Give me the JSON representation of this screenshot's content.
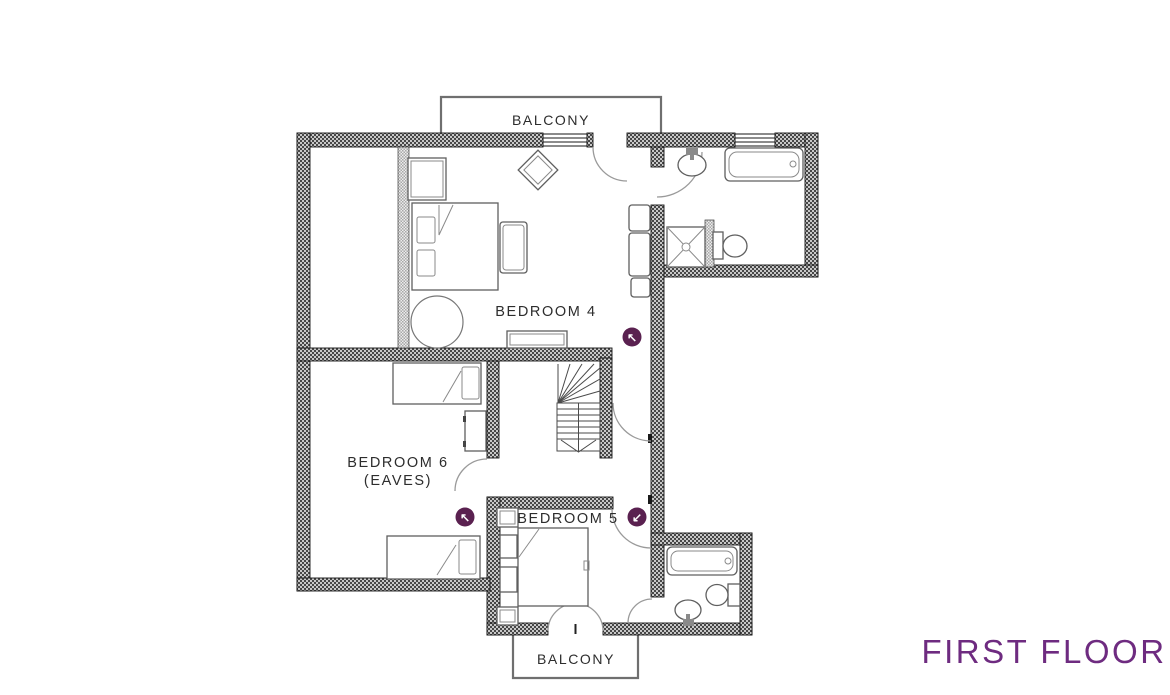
{
  "title": "FIRST FLOOR",
  "colors": {
    "title_purple": "#6e2b80",
    "marker_plum": "#5a2150",
    "wall_dark": "#474747",
    "wall_light": "#c8c8c8"
  },
  "labels": {
    "balcony_top": "BALCONY",
    "bedroom4": "BEDROOM 4",
    "bedroom6_line1": "BEDROOM 6",
    "bedroom6_line2": "(EAVES)",
    "bedroom5": "BEDROOM 5",
    "balcony_bottom": "BALCONY"
  },
  "markers": [
    {
      "id": "passage-arrow",
      "symbol": "↖"
    },
    {
      "id": "bedroom6-arrow",
      "symbol": "↖"
    },
    {
      "id": "corridor-arrow",
      "symbol": "↙"
    }
  ]
}
